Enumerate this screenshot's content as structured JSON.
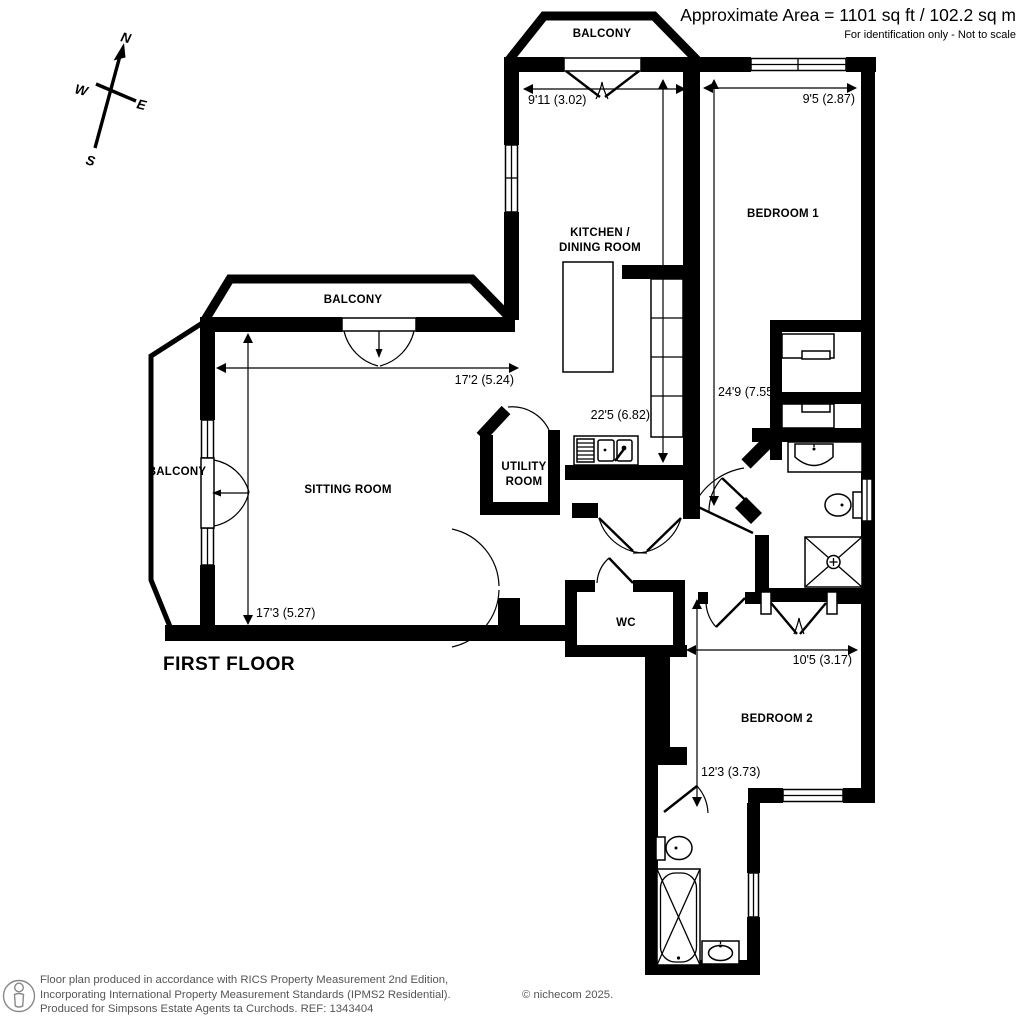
{
  "title_block": {
    "area": "Approximate Area = 1101 sq ft / 102.2 sq m",
    "note": "For identification only - Not to scale"
  },
  "compass": {
    "north": "N",
    "south": "S",
    "east": "E",
    "west": "W"
  },
  "floor_label": "FIRST FLOOR",
  "rooms": {
    "balcony_top": "BALCONY",
    "balcony_middle": "BALCONY",
    "balcony_left": "BALCONY",
    "kitchen_line1": "KITCHEN /",
    "kitchen_line2": "DINING ROOM",
    "bedroom1": "BEDROOM 1",
    "sitting_room": "SITTING ROOM",
    "utility_line1": "UTILITY",
    "utility_line2": "ROOM",
    "wc": "WC",
    "bedroom2": "BEDROOM 2"
  },
  "dimensions": {
    "kitchen_width": "9'11 (3.02)",
    "bedroom1_width": "9'5 (2.87)",
    "kitchen_length": "22'5 (6.82)",
    "bedroom1_length": "24'9 (7.55)",
    "sitting_width": "17'2 (5.24)",
    "sitting_length": "17'3 (5.27)",
    "bedroom2_width": "10'5 (3.17)",
    "bedroom2_length": "12'3 (3.73)"
  },
  "footer": {
    "line1": "Floor plan produced in accordance with RICS Property Measurement 2nd Edition,",
    "line2": "Incorporating International Property Measurement Standards (IPMS2 Residential).",
    "copyright": "© nichecom 2025.",
    "line3": "Produced for Simpsons Estate Agents ta Curchods.   REF: 1343404"
  }
}
